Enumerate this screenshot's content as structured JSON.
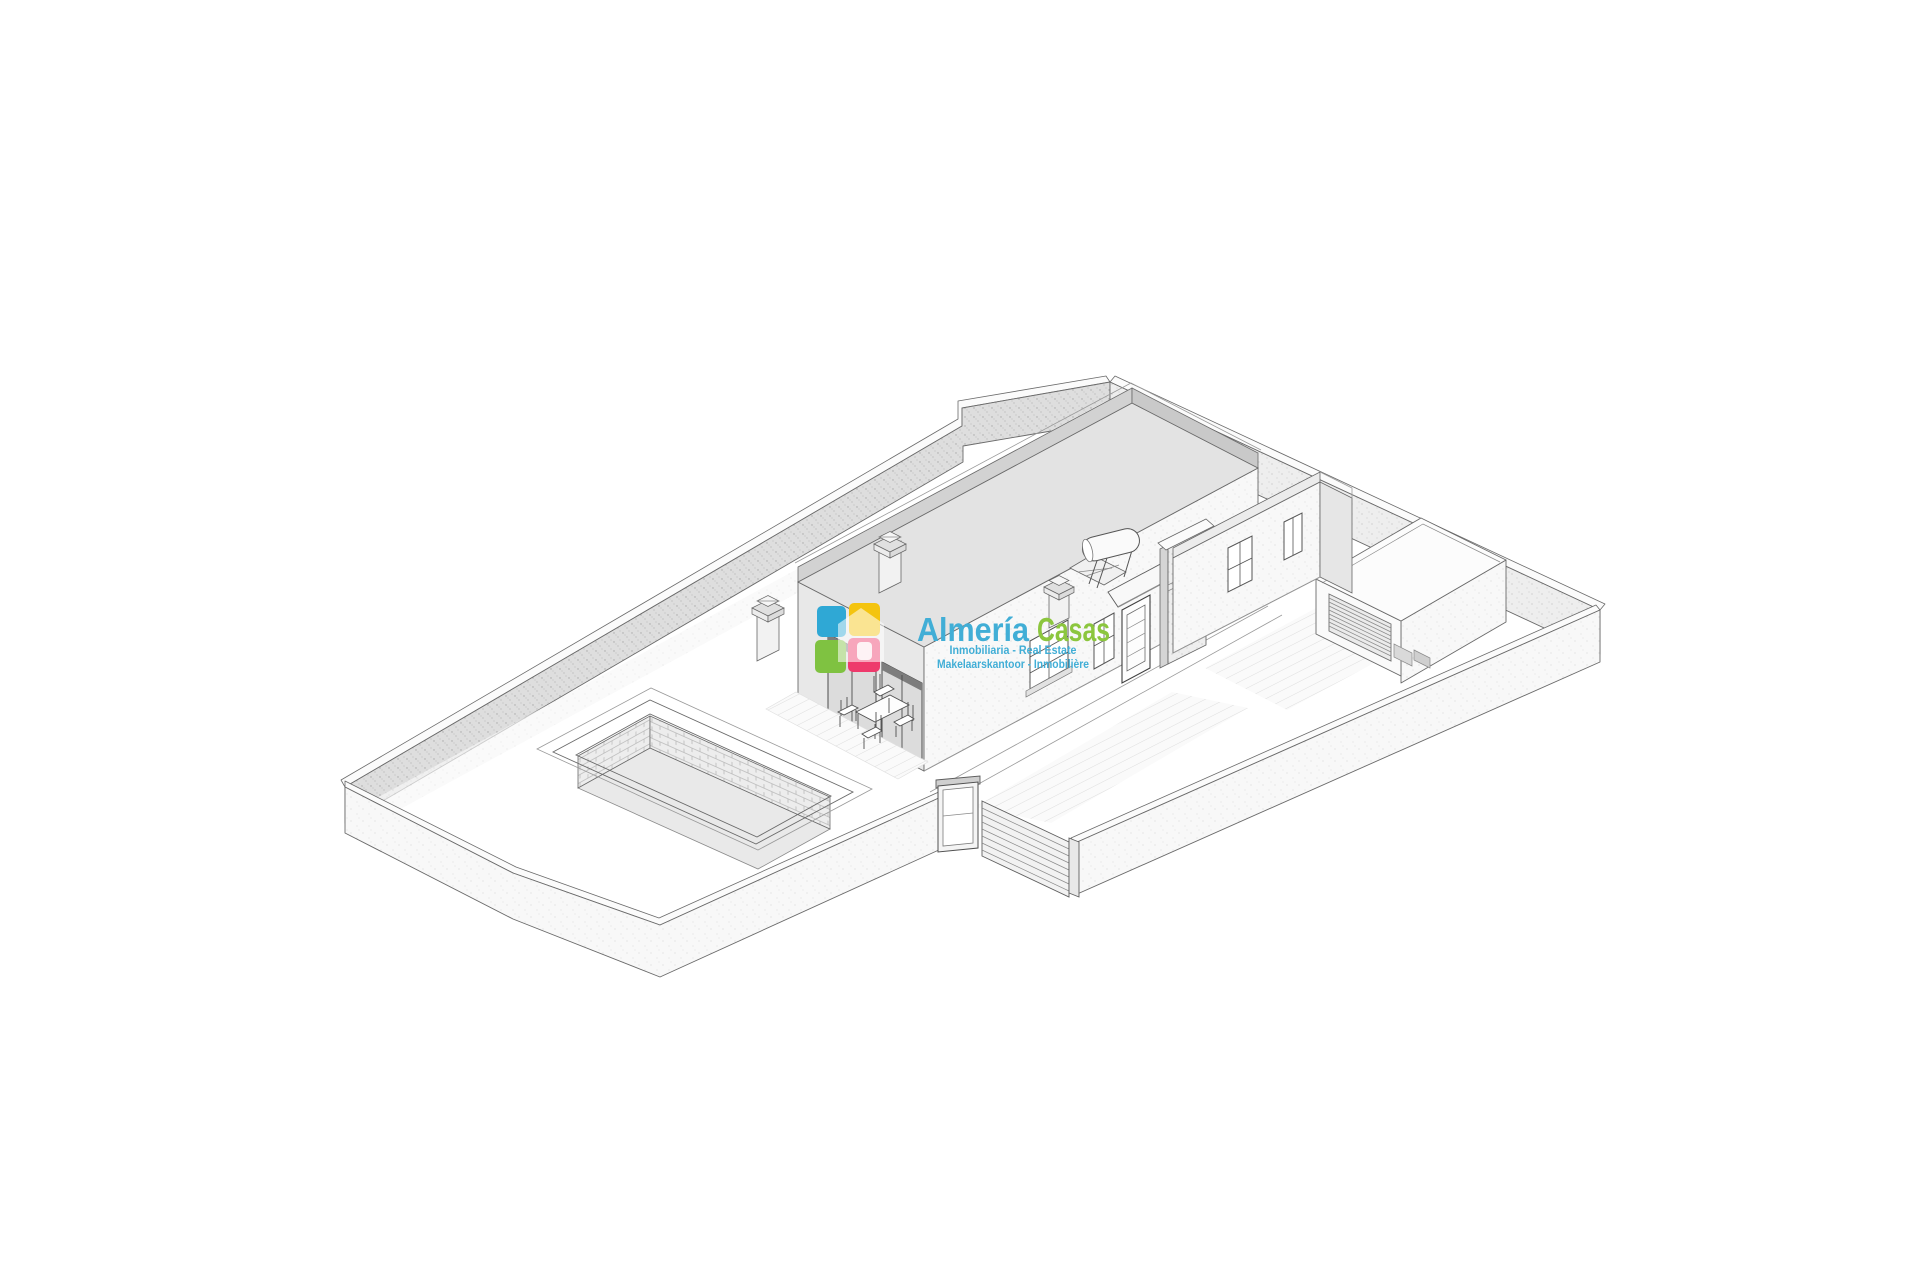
{
  "page": {
    "background_color": "#ffffff"
  },
  "watermark": {
    "brand_name_part1": "Almería",
    "brand_name_part2": "Casas",
    "tagline_line1": "Inmobiliaria - Real Estate",
    "tagline_line2": "Makelaarskantoor - Inmobilière",
    "colors": {
      "brand_blue": "#41aed6",
      "brand_green": "#8cc63e",
      "icon_blue": "#2fa8d5",
      "icon_yellow": "#f4c40f",
      "icon_green": "#7fc241",
      "icon_pink": "#ee3a6c"
    }
  },
  "scene": {
    "type": "architectural-3d-isometric-rendering",
    "elements": [
      "perimeter-wall",
      "single-storey-house",
      "flat-roof",
      "chimneys",
      "solar-water-heater",
      "swimming-pool",
      "garage",
      "sliding-gate",
      "pedestrian-door",
      "patio-table-and-chairs"
    ]
  }
}
